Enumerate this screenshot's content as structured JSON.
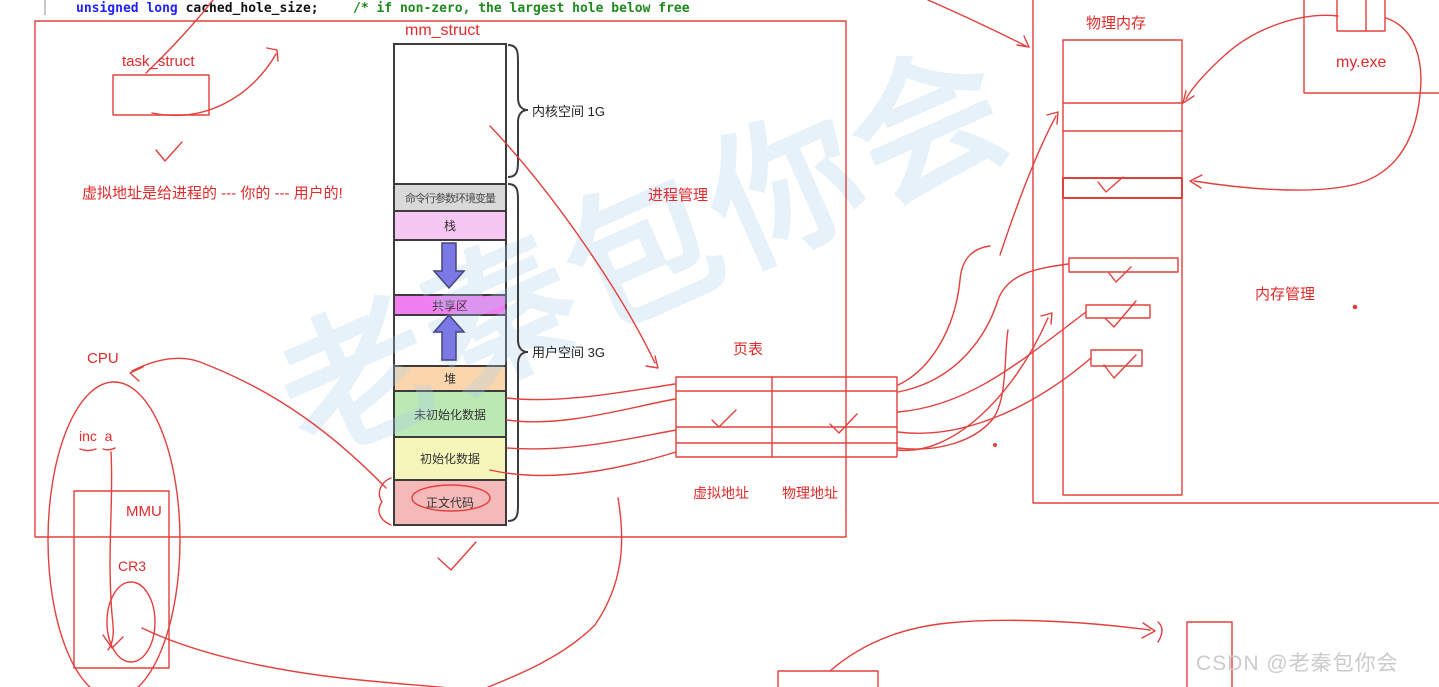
{
  "code": {
    "keyword": "unsigned long",
    "identifier": " cached_hole_size;",
    "comment": "/* if non-zero, the largest hole below free"
  },
  "labels": {
    "task_struct": "task_struct",
    "mm_struct": "mm_struct",
    "kernel_space": "内核空间 1G",
    "user_space": "用户空间 3G",
    "note": "虚拟地址是给进程的 --- 你的  --- 用户的!",
    "process_mgmt": "进程管理",
    "page_table": "页表",
    "virtual_addr": "虚拟地址",
    "physical_addr": "物理地址",
    "physical_memory": "物理内存",
    "memory_mgmt": "内存管理",
    "my_exe": "my.exe",
    "cpu": "CPU",
    "instruction": "inc  a",
    "mmu": "MMU",
    "cr3": "CR3"
  },
  "segments": [
    {
      "label": "命令行参数环境变量",
      "color": "#d9d9d9"
    },
    {
      "label": "栈",
      "color": "#f6c7f3"
    },
    {
      "label": "共享区",
      "color": "#f07ff0"
    },
    {
      "label": "堆",
      "color": "#fbd6ad"
    },
    {
      "label": "未初始化数据",
      "color": "#bce8b4"
    },
    {
      "label": "初始化数据",
      "color": "#f6f6bb"
    },
    {
      "label": "正文代码",
      "color": "#f5b9b9"
    }
  ],
  "watermark": {
    "csdn": "CSDN @老秦包你会",
    "background": "老秦包你会"
  },
  "colors": {
    "sketch_stroke": "#e2403d",
    "box_border": "#3c3c3c",
    "code_keyword": "#1f1fff",
    "code_comment": "#1e8a1e",
    "growth_arrow_fill": "#7b79e6",
    "csdn_watermark_gray": "#cbcbcb",
    "background_watermark_blue": "#a9cfec"
  }
}
